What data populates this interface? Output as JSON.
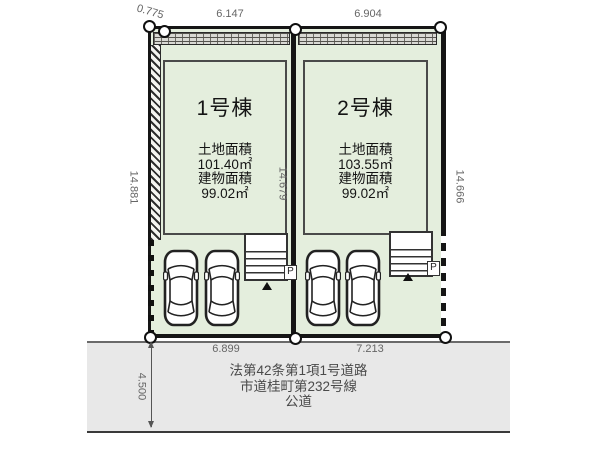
{
  "site": {
    "buildings": [
      {
        "name": "1号棟",
        "land_area_label": "土地面積",
        "land_area": "101.40㎡",
        "building_area_label": "建物面積",
        "building_area": "99.02㎡"
      },
      {
        "name": "2号棟",
        "land_area_label": "土地面積",
        "land_area": "103.55㎡",
        "building_area_label": "建物面積",
        "building_area": "99.02㎡"
      }
    ],
    "dimensions": {
      "top_jog": "0.775",
      "top_lot1": "6.147",
      "top_lot2": "6.904",
      "left": "14.881",
      "center": "14.679",
      "right": "14.666",
      "bottom_lot1": "6.899",
      "bottom_lot2": "7.213",
      "road_width": "4.500"
    },
    "parking_label": "P"
  },
  "road": {
    "lines": [
      "法第42条第1項1号道路",
      "市道桂町第232号線",
      "公道"
    ]
  },
  "colors": {
    "lot_fill": "#e4eedd",
    "road_fill": "#e8e8e8",
    "boundary": "#151515",
    "dimension_text": "#666666",
    "road_text": "#4a4a4a"
  }
}
